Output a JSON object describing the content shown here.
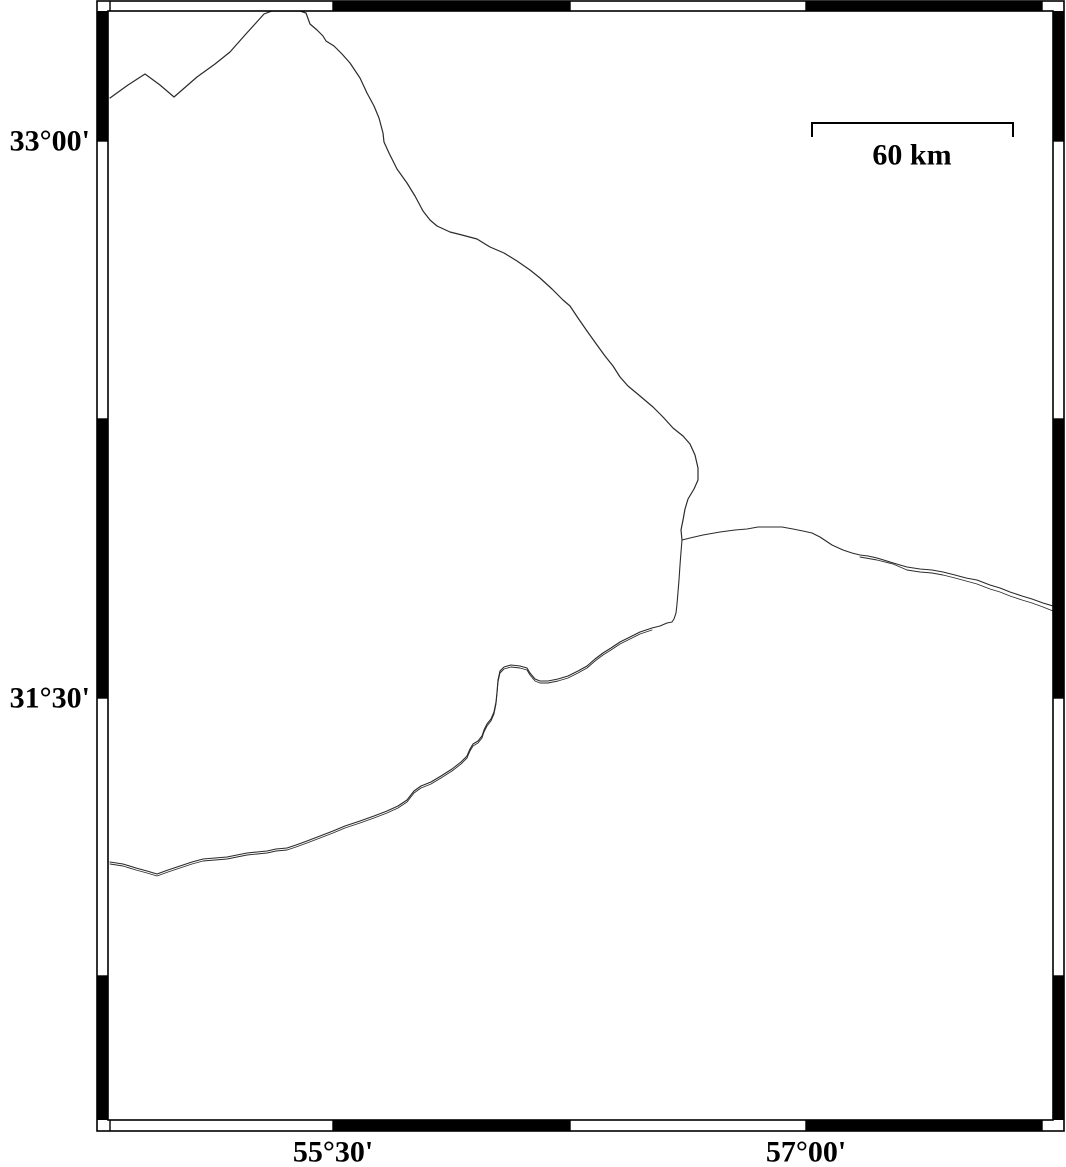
{
  "page": {
    "background": "#ffffff"
  },
  "map": {
    "frame": {
      "outer": [
        97,
        1,
        1064,
        1131
      ],
      "inner": [
        108,
        11,
        1053,
        1120
      ],
      "frame_color": "#000000",
      "band_fill": "#000000",
      "top_black_x": [
        [
          333,
          570
        ],
        [
          806,
          1042
        ]
      ],
      "bottom_black_x": [
        [
          333,
          570
        ],
        [
          806,
          1042
        ]
      ],
      "left_black_y": [
        [
          11,
          141
        ],
        [
          419,
          698
        ],
        [
          976,
          1120
        ]
      ],
      "right_black_y": [
        [
          11,
          141
        ],
        [
          419,
          698
        ],
        [
          976,
          1120
        ]
      ],
      "top_tick_x": [
        110,
        333,
        570,
        806,
        1042
      ],
      "side_tick_y": [
        141,
        419,
        698,
        976
      ]
    },
    "labels": {
      "lat": [
        {
          "text": "33°00'",
          "x": 90,
          "y": 141
        },
        {
          "text": "31°30'",
          "x": 90,
          "y": 698
        }
      ],
      "lon": [
        {
          "text": "55°30'",
          "x": 333,
          "y": 1152
        },
        {
          "text": "57°00'",
          "x": 806,
          "y": 1152
        }
      ]
    },
    "scale_bar": {
      "label": "60 km",
      "x1": 812,
      "x2": 1013,
      "y": 123,
      "tick_drop": 14,
      "label_x": 912,
      "label_y": 155
    },
    "line_color": "#2b2b2b",
    "boundaries": [
      {
        "id": "boundary-north",
        "width": 1.2,
        "points": [
          [
            110,
            98
          ],
          [
            128,
            85
          ],
          [
            145,
            74
          ],
          [
            160,
            85
          ],
          [
            174,
            97
          ],
          [
            197,
            77
          ],
          [
            215,
            64
          ],
          [
            230,
            52
          ],
          [
            245,
            35
          ],
          [
            255,
            24
          ],
          [
            264,
            14
          ],
          [
            272,
            11
          ],
          [
            300,
            11
          ],
          [
            306,
            13
          ],
          [
            310,
            24
          ],
          [
            317,
            30
          ],
          [
            323,
            36
          ],
          [
            326,
            41
          ],
          [
            334,
            46
          ],
          [
            342,
            54
          ],
          [
            350,
            63
          ],
          [
            360,
            78
          ],
          [
            367,
            93
          ],
          [
            374,
            106
          ],
          [
            379,
            118
          ],
          [
            383,
            133
          ],
          [
            384,
            142
          ],
          [
            389,
            153
          ],
          [
            397,
            169
          ],
          [
            407,
            183
          ],
          [
            415,
            196
          ],
          [
            423,
            211
          ],
          [
            430,
            220
          ],
          [
            437,
            226
          ],
          [
            450,
            232
          ],
          [
            462,
            235
          ],
          [
            477,
            239
          ],
          [
            490,
            247
          ],
          [
            504,
            253
          ],
          [
            517,
            261
          ],
          [
            530,
            270
          ],
          [
            540,
            278
          ],
          [
            552,
            289
          ],
          [
            563,
            300
          ],
          [
            570,
            306
          ],
          [
            578,
            318
          ],
          [
            587,
            331
          ],
          [
            597,
            345
          ],
          [
            605,
            356
          ],
          [
            613,
            366
          ],
          [
            620,
            377
          ],
          [
            628,
            386
          ],
          [
            640,
            396
          ],
          [
            653,
            407
          ],
          [
            663,
            417
          ],
          [
            673,
            428
          ],
          [
            683,
            436
          ],
          [
            690,
            444
          ],
          [
            695,
            455
          ],
          [
            698,
            468
          ],
          [
            698,
            480
          ],
          [
            694,
            489
          ],
          [
            688,
            499
          ],
          [
            685,
            509
          ],
          [
            683,
            520
          ],
          [
            681,
            530
          ],
          [
            682,
            540
          ]
        ]
      },
      {
        "id": "boundary-east",
        "width": 1.1,
        "points": [
          [
            682,
            540
          ],
          [
            690,
            538
          ],
          [
            703,
            535
          ],
          [
            720,
            532
          ],
          [
            735,
            530
          ],
          [
            747,
            529
          ],
          [
            758,
            527
          ],
          [
            770,
            527
          ],
          [
            782,
            527
          ],
          [
            793,
            529
          ],
          [
            803,
            531
          ],
          [
            812,
            533
          ],
          [
            820,
            537
          ],
          [
            832,
            545
          ],
          [
            843,
            550
          ],
          [
            852,
            553
          ],
          [
            860,
            555
          ],
          [
            868,
            556
          ],
          [
            877,
            558
          ],
          [
            890,
            562
          ],
          [
            900,
            565
          ],
          [
            907,
            567
          ],
          [
            920,
            569
          ],
          [
            932,
            570
          ],
          [
            943,
            572
          ],
          [
            955,
            575
          ],
          [
            966,
            578
          ],
          [
            977,
            580
          ],
          [
            990,
            585
          ],
          [
            1000,
            588
          ],
          [
            1010,
            592
          ],
          [
            1022,
            596
          ],
          [
            1032,
            599
          ],
          [
            1043,
            603
          ],
          [
            1053,
            606
          ]
        ]
      },
      {
        "id": "boundary-east-parallel",
        "width": 0.9,
        "points": [
          [
            860,
            557
          ],
          [
            877,
            560
          ],
          [
            893,
            564
          ],
          [
            907,
            570
          ],
          [
            920,
            572
          ],
          [
            932,
            573
          ],
          [
            943,
            575
          ],
          [
            955,
            578
          ],
          [
            966,
            581
          ],
          [
            977,
            584
          ],
          [
            990,
            589
          ],
          [
            1000,
            592
          ],
          [
            1010,
            596
          ],
          [
            1022,
            600
          ],
          [
            1032,
            603
          ],
          [
            1043,
            607
          ],
          [
            1053,
            611
          ]
        ]
      },
      {
        "id": "boundary-southwest",
        "width": 1.1,
        "points": [
          [
            682,
            540
          ],
          [
            681,
            552
          ],
          [
            680,
            565
          ],
          [
            679,
            580
          ],
          [
            678,
            592
          ],
          [
            677,
            604
          ],
          [
            676,
            613
          ],
          [
            674,
            619
          ],
          [
            672,
            622
          ],
          [
            667,
            623
          ],
          [
            660,
            626
          ],
          [
            652,
            628
          ],
          [
            640,
            632
          ],
          [
            630,
            637
          ],
          [
            620,
            642
          ],
          [
            611,
            648
          ],
          [
            603,
            653
          ],
          [
            595,
            659
          ],
          [
            587,
            666
          ],
          [
            578,
            671
          ],
          [
            568,
            676
          ],
          [
            558,
            679
          ],
          [
            548,
            681
          ],
          [
            540,
            681
          ],
          [
            535,
            679
          ],
          [
            530,
            673
          ],
          [
            527,
            668
          ],
          [
            520,
            666
          ],
          [
            511,
            665
          ],
          [
            504,
            667
          ],
          [
            500,
            671
          ],
          [
            498,
            680
          ],
          [
            497,
            692
          ],
          [
            496,
            702
          ],
          [
            494,
            712
          ],
          [
            491,
            719
          ],
          [
            487,
            724
          ],
          [
            484,
            730
          ],
          [
            482,
            736
          ],
          [
            478,
            741
          ],
          [
            473,
            744
          ],
          [
            470,
            749
          ],
          [
            467,
            756
          ],
          [
            461,
            762
          ],
          [
            452,
            769
          ],
          [
            441,
            776
          ],
          [
            431,
            782
          ],
          [
            421,
            786
          ],
          [
            414,
            791
          ],
          [
            407,
            800
          ],
          [
            398,
            806
          ],
          [
            387,
            811
          ],
          [
            374,
            816
          ],
          [
            360,
            821
          ],
          [
            345,
            826
          ],
          [
            333,
            831
          ],
          [
            320,
            836
          ],
          [
            307,
            841
          ],
          [
            296,
            845
          ],
          [
            287,
            848
          ],
          [
            276,
            849
          ],
          [
            267,
            851
          ],
          [
            257,
            852
          ],
          [
            247,
            853
          ],
          [
            237,
            855
          ],
          [
            227,
            857
          ],
          [
            215,
            858
          ],
          [
            203,
            859
          ],
          [
            192,
            862
          ],
          [
            180,
            866
          ],
          [
            168,
            870
          ],
          [
            157,
            874
          ],
          [
            147,
            871
          ],
          [
            136,
            868
          ],
          [
            123,
            864
          ],
          [
            110,
            862
          ]
        ]
      },
      {
        "id": "boundary-southwest-parallel",
        "width": 0.9,
        "points": [
          [
            652,
            630
          ],
          [
            640,
            634
          ],
          [
            630,
            639
          ],
          [
            620,
            644
          ],
          [
            611,
            650
          ],
          [
            603,
            655
          ],
          [
            595,
            661
          ],
          [
            587,
            668
          ],
          [
            578,
            673
          ],
          [
            568,
            678
          ],
          [
            558,
            681
          ],
          [
            548,
            683
          ],
          [
            540,
            683
          ],
          [
            535,
            681
          ],
          [
            530,
            675
          ],
          [
            527,
            670
          ],
          [
            520,
            668
          ],
          [
            511,
            667
          ],
          [
            504,
            669
          ],
          [
            500,
            673
          ],
          [
            498,
            682
          ],
          [
            497,
            694
          ],
          [
            496,
            704
          ],
          [
            494,
            714
          ],
          [
            491,
            721
          ],
          [
            487,
            726
          ],
          [
            484,
            732
          ],
          [
            482,
            738
          ],
          [
            478,
            743
          ],
          [
            473,
            746
          ],
          [
            470,
            751
          ],
          [
            467,
            758
          ],
          [
            461,
            764
          ],
          [
            452,
            771
          ],
          [
            441,
            778
          ],
          [
            431,
            784
          ],
          [
            421,
            788
          ],
          [
            414,
            793
          ],
          [
            407,
            802
          ],
          [
            398,
            808
          ],
          [
            387,
            813
          ],
          [
            374,
            818
          ],
          [
            360,
            823
          ],
          [
            345,
            828
          ],
          [
            333,
            833
          ],
          [
            320,
            838
          ],
          [
            307,
            843
          ],
          [
            296,
            847
          ],
          [
            287,
            850
          ],
          [
            276,
            851
          ],
          [
            267,
            853
          ],
          [
            257,
            854
          ],
          [
            247,
            855
          ],
          [
            237,
            857
          ],
          [
            227,
            859
          ],
          [
            215,
            860
          ],
          [
            203,
            861
          ],
          [
            192,
            864
          ],
          [
            180,
            868
          ],
          [
            168,
            872
          ],
          [
            157,
            876
          ],
          [
            147,
            873
          ],
          [
            136,
            870
          ],
          [
            123,
            866
          ],
          [
            110,
            864
          ]
        ]
      }
    ]
  }
}
